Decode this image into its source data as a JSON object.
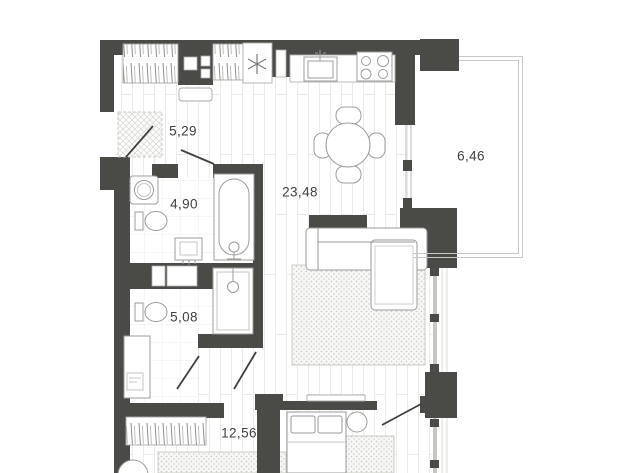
{
  "plan": {
    "type": "apartment-floor-plan",
    "rooms": [
      {
        "id": "hallway",
        "area_label": "5,29",
        "area_m2": 5.29
      },
      {
        "id": "bathroom",
        "area_label": "4,90",
        "area_m2": 4.9
      },
      {
        "id": "kitchen-living-room",
        "area_label": "23,48",
        "area_m2": 23.48
      },
      {
        "id": "balcony",
        "area_label": "6,46",
        "area_m2": 6.46
      },
      {
        "id": "shower-room",
        "area_label": "5,08",
        "area_m2": 5.08
      },
      {
        "id": "bedroom-corridor",
        "area_label": "12,56",
        "area_m2": 12.56
      }
    ],
    "fixtures": {
      "hallway": [
        "wardrobe",
        "ventilation-shaft",
        "wardrobe",
        "extractor-fan",
        "bench",
        "doormat",
        "entrance-door"
      ],
      "bathroom": [
        "washing-machine",
        "toilet",
        "washbasin",
        "bathtub"
      ],
      "shower-room": [
        "toilet",
        "shower-cabin",
        "vanity-washbasin"
      ],
      "kitchen-living-room": [
        "kitchen-counter",
        "kitchen-sink",
        "cooktop-4-burners",
        "dining-table-with-4-chairs",
        "tv-console",
        "corner-sofa",
        "rug",
        "wall-shelf"
      ],
      "bedroom-corridor": [
        "wardrobe",
        "double-bed-2-pillows",
        "bedside-table",
        "rug",
        "side-table"
      ],
      "balcony": []
    },
    "colors": {
      "wall": "#4a4a47",
      "floor": "#ffffff",
      "floor_line": "#ebebe7",
      "fixture_outline": "#9c9c9a",
      "label_text": "#3f3f3f"
    }
  }
}
